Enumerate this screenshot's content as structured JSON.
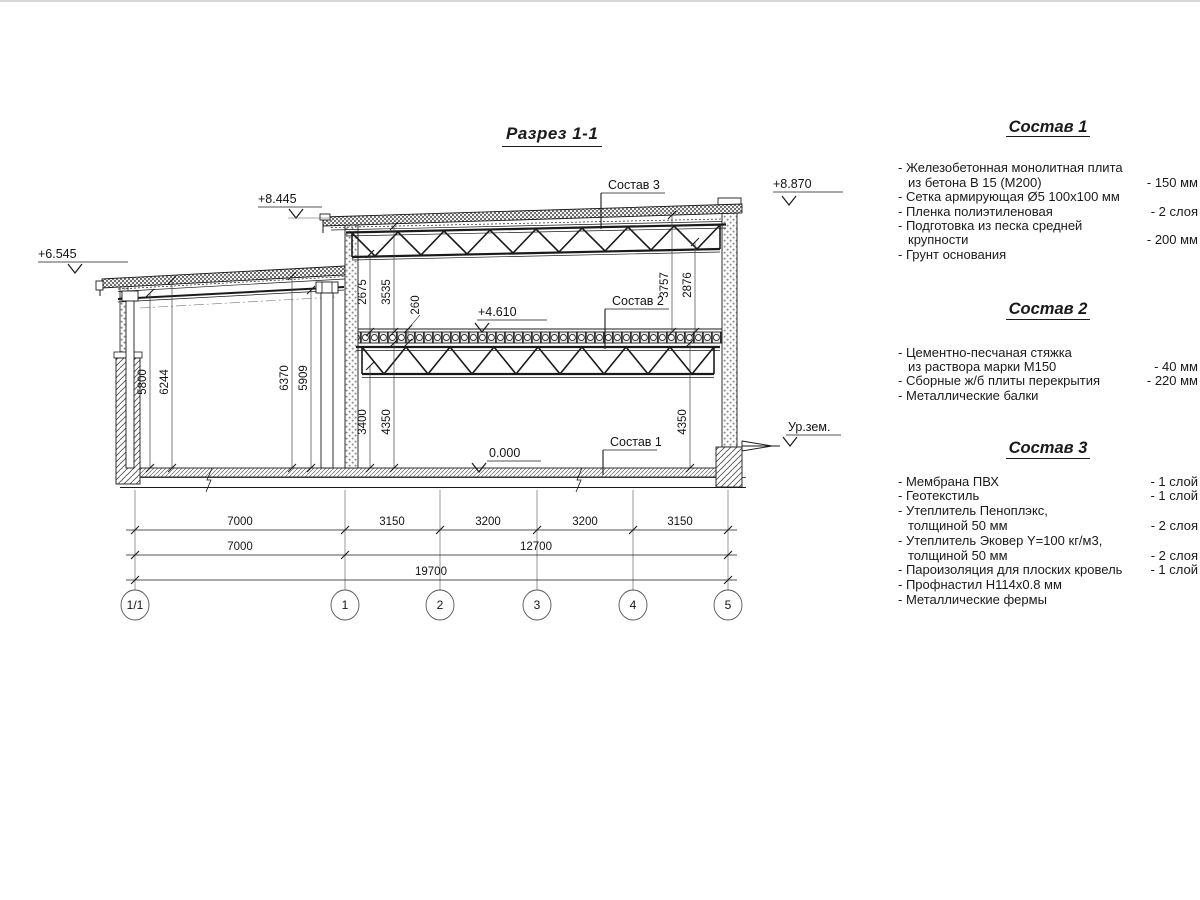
{
  "title": "Разрез 1-1",
  "section": {
    "callout_1": "Состав 1",
    "callout_2": "Состав 2",
    "callout_3": "Состав 3",
    "elev_annex": "+6.545",
    "elev_roof_left": "+8.445",
    "elev_parapet": "+8.870",
    "elev_mid_floor": "+4.610",
    "elev_zero": "0.000",
    "elev_ground": "Ур.зем.",
    "dims_annex": {
      "d1": "5800",
      "d2": "6244",
      "d3": "6370",
      "d4": "5909"
    },
    "dims_upper": {
      "d1": "2675",
      "d2": "3535",
      "d3": "260",
      "d4": "3757",
      "d5": "2876"
    },
    "dims_lower": {
      "d1": "3400",
      "d2": "4350",
      "d3": "4350"
    },
    "dim_row1": {
      "s1": "7000",
      "s2": "3150",
      "s3": "3200",
      "s4": "3200",
      "s5": "3150"
    },
    "dim_row2": {
      "s1": "7000",
      "s2": "12700"
    },
    "dim_row3": {
      "s1": "19700"
    },
    "axes": {
      "a0": "1/1",
      "a1": "1",
      "a2": "2",
      "a3": "3",
      "a4": "4",
      "a5": "5"
    }
  },
  "notes": [
    {
      "heading": "Состав 1",
      "items": [
        {
          "l1": "- Железобетонная  монолитная плита",
          "l2": "из бетона В 15 (М200)",
          "value": "- 150 мм"
        },
        {
          "l1": "- Сетка армирующая Ø5 100х100 мм",
          "l2": "",
          "value": ""
        },
        {
          "l1": "- Пленка полиэтиленовая",
          "l2": "",
          "value": "-  2 слоя"
        },
        {
          "l1": "- Подготовка из песка средней",
          "l2": "крупности",
          "value": "- 200 мм"
        },
        {
          "l1": "- Грунт основания",
          "l2": "",
          "value": ""
        }
      ]
    },
    {
      "heading": "Состав 2",
      "items": [
        {
          "l1": "- Цементно-песчаная стяжка",
          "l2": "из раствора марки М150",
          "value": "- 40 мм"
        },
        {
          "l1": "- Сборные ж/б плиты перекрытия",
          "l2": "",
          "value": "- 220 мм"
        },
        {
          "l1": "- Металлические балки",
          "l2": "",
          "value": ""
        }
      ]
    },
    {
      "heading": "Состав 3",
      "items": [
        {
          "l1": "- Мембрана ПВХ",
          "l2": "",
          "value": "- 1 слой"
        },
        {
          "l1": "- Геотекстиль",
          "l2": "",
          "value": "- 1 слой"
        },
        {
          "l1": "- Утеплитель Пеноплэкс,",
          "l2": "толщиной 50 мм",
          "value": "- 2 слоя"
        },
        {
          "l1": "- Утеплитель Эковер Y=100 кг/м3,",
          "l2": "толщиной 50 мм",
          "value": "- 2 слоя"
        },
        {
          "l1": "- Пароизоляция для плоских кровель",
          "l2": "",
          "value": "- 1 слой"
        },
        {
          "l1": "- Профнастил Н114х0.8 мм",
          "l2": "",
          "value": ""
        },
        {
          "l1": "- Металлические фермы",
          "l2": "",
          "value": ""
        }
      ]
    }
  ]
}
